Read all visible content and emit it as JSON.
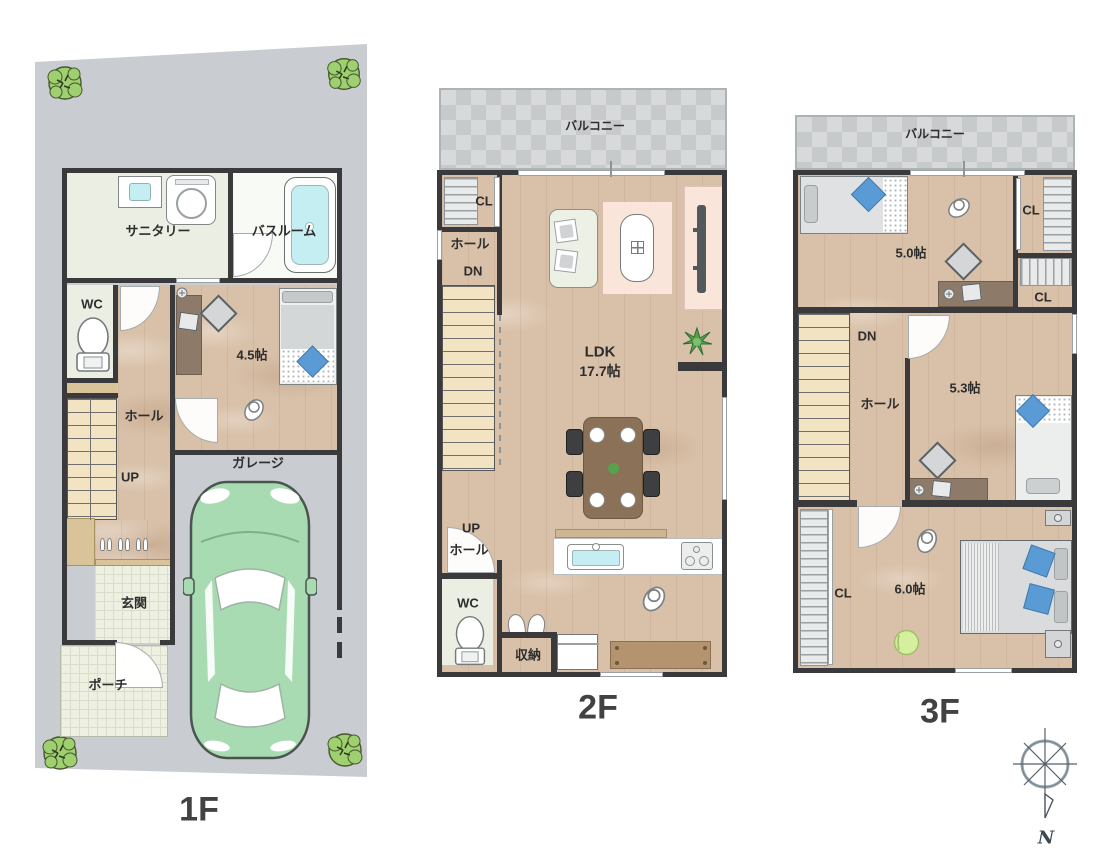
{
  "palette": {
    "lot_gray": "#c9cdd1",
    "wall": "#3a3a3c",
    "wood_floor": "#d9c1a9",
    "stairs_beige": "#f2e4c2",
    "tile_green": "#eef0e1",
    "water_cyan": "#c5eef3",
    "car_green": "#a8dbb2",
    "tree_green": "#9ed06f",
    "pillow_blue": "#5b9bd5",
    "rug_peach": "#f9e5da",
    "table_brown": "#8a7157",
    "cabinet_brown": "#b3946f"
  },
  "floor1": {
    "label": "1F",
    "rooms": {
      "sanitary": "サニタリー",
      "bathroom": "バスルーム",
      "wc": "WC",
      "hall": "ホール",
      "up": "UP",
      "room_45": "4.5帖",
      "garage": "ガレージ",
      "entrance": "玄関",
      "porch": "ポーチ"
    }
  },
  "floor2": {
    "label": "2F",
    "rooms": {
      "balcony": "バルコニー",
      "closet": "CL",
      "hall_upper": "ホール",
      "down": "DN",
      "ldk_name": "LDK",
      "ldk_size": "17.7帖",
      "up": "UP",
      "hall_lower": "ホール",
      "wc": "WC",
      "storage": "収納"
    }
  },
  "floor3": {
    "label": "3F",
    "rooms": {
      "balcony": "バルコニー",
      "room_50": "5.0帖",
      "closet_a": "CL",
      "closet_b": "CL",
      "down": "DN",
      "hall": "ホール",
      "room_53": "5.3帖",
      "closet_c": "CL",
      "room_60": "6.0帖"
    }
  },
  "compass": {
    "north": "N"
  }
}
